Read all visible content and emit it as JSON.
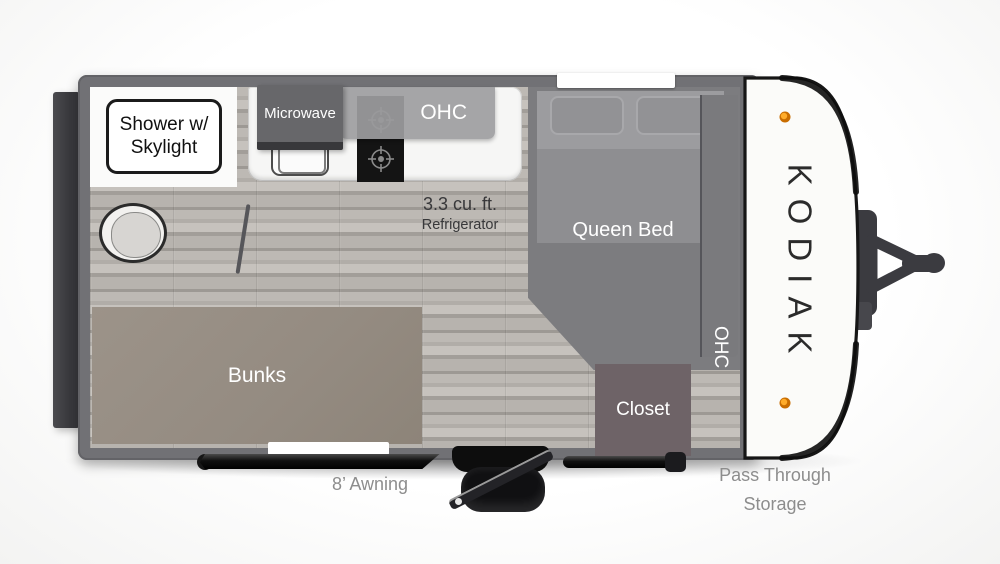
{
  "brand": {
    "name": "KODIAK"
  },
  "rooms": {
    "shower": {
      "line1": "Shower w/",
      "line2": "Skylight"
    },
    "microwave": "Microwave",
    "kitchen_ohc": "OHC",
    "refrigerator": {
      "line1": "3.3 cu. ft.",
      "line2": "Refrigerator"
    },
    "queen_bed": "Queen Bed",
    "bedroom_ohc": "OHC",
    "closet": "Closet",
    "bunks": "Bunks"
  },
  "exterior": {
    "awning": "8’ Awning",
    "pass_through_line1": "Pass Through",
    "pass_through_line2": "Storage"
  },
  "colors": {
    "wall": "#717175",
    "floor": "#aca8a3",
    "bunks": "#948b81",
    "closet": "#6e6367",
    "bed_platform": "#7c7c7f",
    "marker_light": "#f59a00",
    "cap": "#fbfbf9"
  }
}
